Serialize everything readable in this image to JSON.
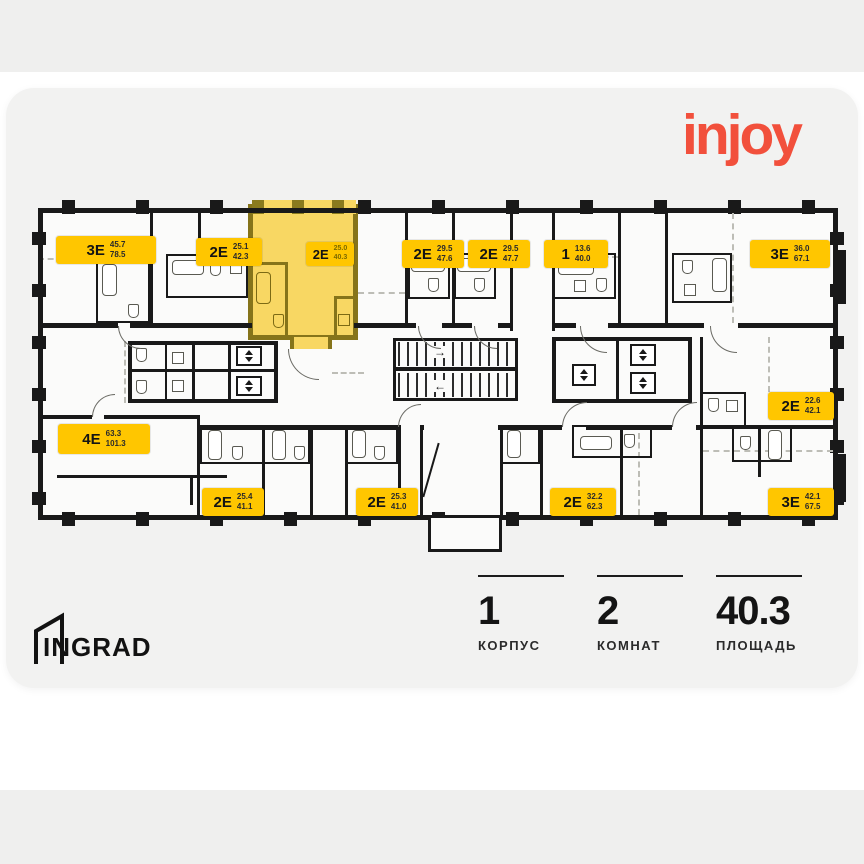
{
  "brand": {
    "logo_text": "injoy",
    "developer_logo_text": "INGRAD"
  },
  "colors": {
    "accent_red": "#f2503c",
    "badge_yellow": "#ffc600",
    "highlight_fill": "#f8d763",
    "highlight_wall": "#86741a",
    "wall_black": "#191919"
  },
  "plan": {
    "units": [
      {
        "code": "3Е",
        "area_top": "45.7",
        "area_bottom": "78.5",
        "highlighted": false
      },
      {
        "code": "2Е",
        "area_top": "25.1",
        "area_bottom": "42.3",
        "highlighted": false
      },
      {
        "code": "2Е",
        "area_top": "25.0",
        "area_bottom": "40.3",
        "highlighted": true
      },
      {
        "code": "2Е",
        "area_top": "29.5",
        "area_bottom": "47.6",
        "highlighted": false
      },
      {
        "code": "2Е",
        "area_top": "29.5",
        "area_bottom": "47.7",
        "highlighted": false
      },
      {
        "code": "1",
        "area_top": "13.6",
        "area_bottom": "40.0",
        "highlighted": false
      },
      {
        "code": "3Е",
        "area_top": "36.0",
        "area_bottom": "67.1",
        "highlighted": false
      },
      {
        "code": "4Е",
        "area_top": "63.3",
        "area_bottom": "101.3",
        "highlighted": false
      },
      {
        "code": "2Е",
        "area_top": "25.4",
        "area_bottom": "41.1",
        "highlighted": false
      },
      {
        "code": "2Е",
        "area_top": "25.3",
        "area_bottom": "41.0",
        "highlighted": false
      },
      {
        "code": "2Е",
        "area_top": "32.2",
        "area_bottom": "62.3",
        "highlighted": false
      },
      {
        "code": "3Е",
        "area_top": "42.1",
        "area_bottom": "67.5",
        "highlighted": false
      },
      {
        "code": "2Е",
        "area_top": "22.6",
        "area_bottom": "42.1",
        "highlighted": false
      }
    ]
  },
  "summary": {
    "building": {
      "value": "1",
      "label": "КОРПУС"
    },
    "rooms": {
      "value": "2",
      "label": "КОМНАТ"
    },
    "area": {
      "value": "40.3",
      "label": "ПЛОЩАДЬ"
    }
  }
}
